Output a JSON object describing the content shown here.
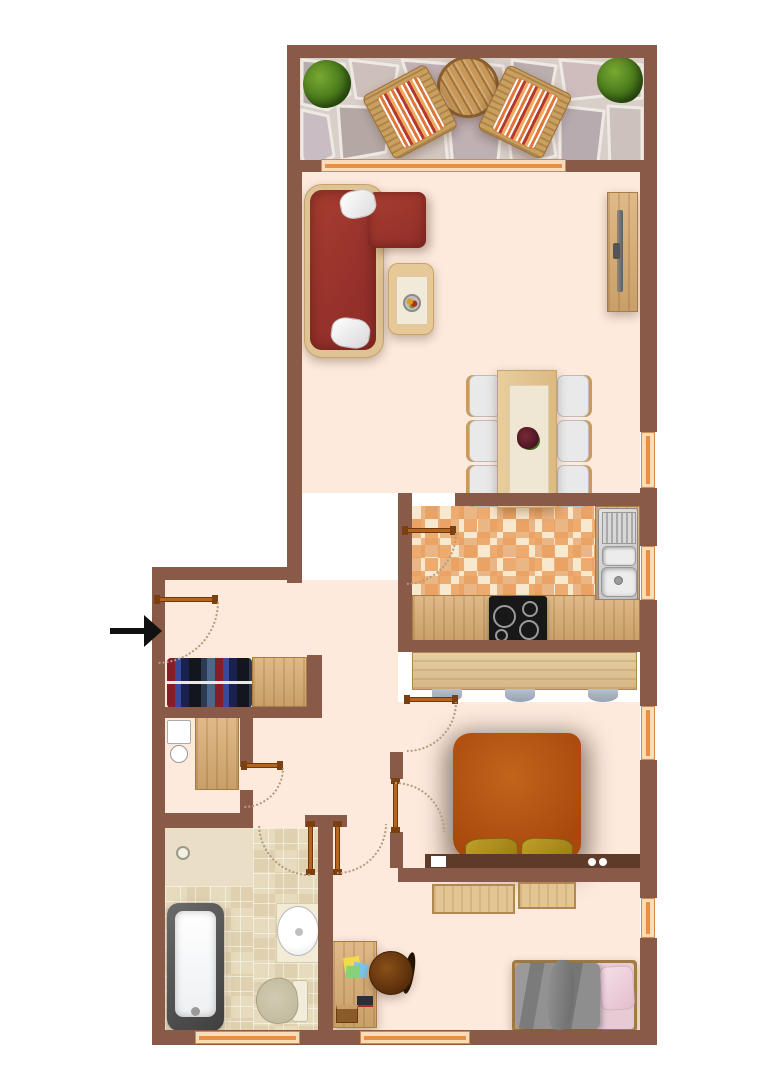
{
  "plan": {
    "type": "apartment-floor-plan",
    "palette": {
      "wall": "#8a5a49",
      "floor": "#fdeadd",
      "wood": "#d9ad72",
      "window_frame": "#ea8f42",
      "door": "#b5651d",
      "door_arc": "#b39b7d",
      "balcony_stone": "#c6bab6",
      "kitchen_tile": "#f0cda0",
      "bathroom_tile": "#e7dbbd",
      "sofa": "#9e372c",
      "double_bed_duvet": "#b5530f",
      "double_bed_pillow": "#ad8c1c",
      "headboard": "#5e3a28",
      "single_bed_duvet": "#8b8b8b",
      "single_bed_pillow": "#ecd0da",
      "plant": "#46761a",
      "desk_chair": "#6e3c10",
      "bathtub_rim": "#4a4a4a",
      "toilet": "#c9c2a8",
      "entry_arrow": "#111111"
    },
    "rooms": [
      {
        "id": "balcony",
        "furniture": [
          "plant",
          "deck-chair",
          "round-table",
          "deck-chair",
          "plant"
        ]
      },
      {
        "id": "living-room",
        "furniture": [
          "corner-sofa",
          "sofa-pillow",
          "sofa-pillow",
          "coffee-table",
          "fruit-bowl",
          "tv-sideboard",
          "tv"
        ]
      },
      {
        "id": "dining-area",
        "furniture": [
          "dining-table",
          "table-runner",
          "centerpiece",
          "chair",
          "chair",
          "chair",
          "chair",
          "chair",
          "chair"
        ]
      },
      {
        "id": "kitchen",
        "furniture": [
          "sink-unit",
          "counter",
          "cooktop",
          "bar-counter",
          "bar-stool",
          "bar-stool",
          "bar-stool"
        ]
      },
      {
        "id": "entry-hall",
        "furniture": [
          "entry-arrow",
          "coat-rail",
          "cabinet"
        ]
      },
      {
        "id": "storage-room",
        "furniture": [
          "washing-machine",
          "small-basin",
          "cabinet"
        ]
      },
      {
        "id": "bathroom",
        "furniture": [
          "floor-drain",
          "bathtub",
          "washbasin",
          "toilet"
        ]
      },
      {
        "id": "bedroom",
        "furniture": [
          "double-bed",
          "pillow",
          "pillow",
          "headboard-console",
          "lamp",
          "sideboard",
          "sideboard"
        ]
      },
      {
        "id": "office-room",
        "furniture": [
          "desk",
          "sticky-notes",
          "notebook",
          "book",
          "office-chair",
          "single-bed",
          "pillow",
          "blanket"
        ]
      }
    ],
    "window_count": 7,
    "door_count": 7
  }
}
